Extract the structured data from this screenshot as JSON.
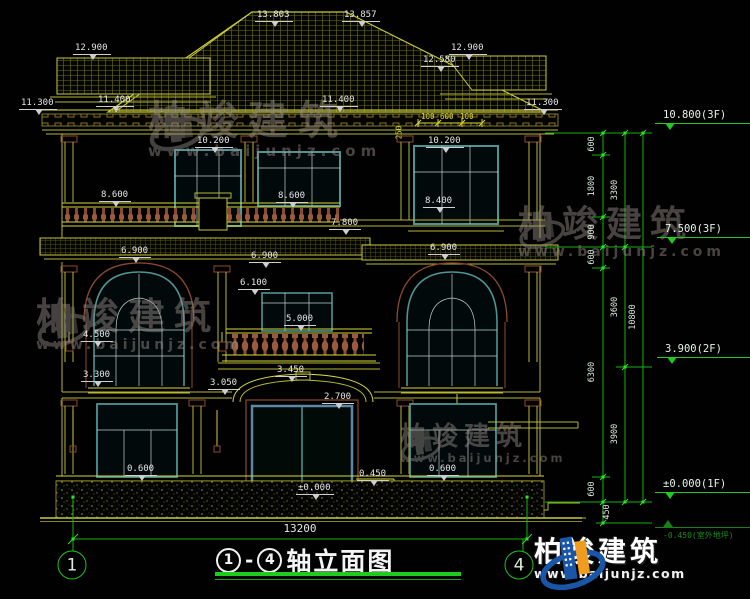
{
  "drawing": {
    "title": {
      "axis_from": "1",
      "axis_to": "4",
      "dash": "-",
      "text": "轴立面图"
    },
    "bottom_dim": {
      "text": "13200"
    },
    "axes": [
      {
        "label": "1",
        "x": 72,
        "y": 565
      },
      {
        "label": "4",
        "x": 519,
        "y": 565
      }
    ],
    "elevation_labels": [
      {
        "text": "13.803",
        "x": 255,
        "y": 10
      },
      {
        "text": "13.857",
        "x": 342,
        "y": 10
      },
      {
        "text": "12.900",
        "x": 73,
        "y": 43
      },
      {
        "text": "12.900",
        "x": 449,
        "y": 43
      },
      {
        "text": "12.580",
        "x": 421,
        "y": 55
      },
      {
        "text": "11.300",
        "x": 19,
        "y": 98
      },
      {
        "text": "11.400",
        "x": 96,
        "y": 95
      },
      {
        "text": "11.400",
        "x": 320,
        "y": 95
      },
      {
        "text": "11.300",
        "x": 524,
        "y": 98
      },
      {
        "text": "10.200",
        "x": 195,
        "y": 136
      },
      {
        "text": "10.200",
        "x": 426,
        "y": 136
      },
      {
        "text": "8.600",
        "x": 99,
        "y": 190
      },
      {
        "text": "8.600",
        "x": 276,
        "y": 191
      },
      {
        "text": "8.400",
        "x": 423,
        "y": 196
      },
      {
        "text": "7.800",
        "x": 329,
        "y": 218
      },
      {
        "text": "6.900",
        "x": 119,
        "y": 246
      },
      {
        "text": "6.900",
        "x": 249,
        "y": 251
      },
      {
        "text": "6.900",
        "x": 428,
        "y": 243
      },
      {
        "text": "6.100",
        "x": 238,
        "y": 278
      },
      {
        "text": "5.000",
        "x": 284,
        "y": 314
      },
      {
        "text": "4.500",
        "x": 81,
        "y": 330
      },
      {
        "text": "3.300",
        "x": 81,
        "y": 370
      },
      {
        "text": "3.050",
        "x": 208,
        "y": 378
      },
      {
        "text": "3.450",
        "x": 275,
        "y": 365
      },
      {
        "text": "2.700",
        "x": 322,
        "y": 392
      },
      {
        "text": "0.600",
        "x": 125,
        "y": 464
      },
      {
        "text": "0.600",
        "x": 427,
        "y": 464
      },
      {
        "text": "0.450",
        "x": 357,
        "y": 469
      },
      {
        "text": "±0.000",
        "x": 296,
        "y": 483
      }
    ],
    "right_markers": [
      {
        "text": "10.800(3F)",
        "x": 655,
        "y": 109
      },
      {
        "text": "7.500(3F)",
        "x": 657,
        "y": 223
      },
      {
        "text": "3.900(2F)",
        "x": 657,
        "y": 343
      },
      {
        "text": "±0.000(1F)",
        "x": 655,
        "y": 478
      },
      {
        "text": "-0.450(室外地坪)",
        "x": 655,
        "y": 527,
        "cls": "faint"
      }
    ],
    "dim_chain": [
      {
        "text": "600",
        "x": 592,
        "y": 144
      },
      {
        "text": "1800",
        "x": 592,
        "y": 186
      },
      {
        "text": "900",
        "x": 592,
        "y": 232
      },
      {
        "text": "600",
        "x": 592,
        "y": 257
      },
      {
        "text": "6300",
        "x": 592,
        "y": 372
      },
      {
        "text": "600",
        "x": 592,
        "y": 489
      },
      {
        "text": "450",
        "x": 607,
        "y": 512
      },
      {
        "text": "3300",
        "x": 615,
        "y": 190
      },
      {
        "text": "3600",
        "x": 615,
        "y": 307
      },
      {
        "text": "3900",
        "x": 615,
        "y": 434
      },
      {
        "text": "10800",
        "x": 633,
        "y": 317
      }
    ],
    "small_dims": [
      {
        "text": "100",
        "x": 421,
        "y": 112
      },
      {
        "text": "600",
        "x": 440,
        "y": 112
      },
      {
        "text": "100",
        "x": 460,
        "y": 112
      },
      {
        "text": "250",
        "x": 392,
        "y": 128,
        "cls": "rot"
      }
    ]
  },
  "watermarks": [
    {
      "cn": "柏竣建筑",
      "url": "www.baijunjz.com"
    },
    {
      "cn": "柏竣建筑",
      "url": "www.baijunjz.com"
    },
    {
      "cn": "柏竣建筑",
      "url": "www.baijunjz.com"
    },
    {
      "cn": "柏竣建筑",
      "url": "www.baijunjz.com"
    }
  ],
  "logo": {
    "cn": "柏竣建筑",
    "url": "www.baijunjz.com"
  },
  "colors": {
    "linework": "#b8b832",
    "bright_line": "#d8d838",
    "window_teal": "#4e9494",
    "trim_brown": "#8a4a30",
    "dim_green": "#1ecb1e",
    "door_blue": "#5b87a8",
    "label_white": "#e6e6e6",
    "watermark_gray": "#958c88",
    "logo_blue": "#1956a8",
    "logo_orange": "#f09c1e"
  }
}
